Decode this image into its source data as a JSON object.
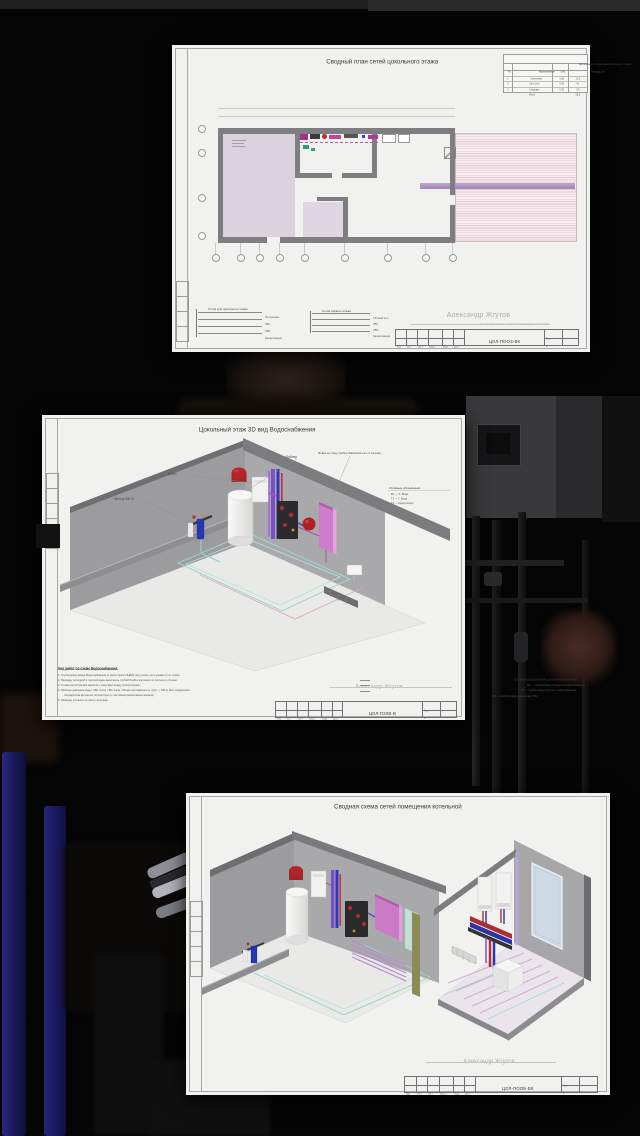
{
  "scene": {
    "colors": {
      "bg": "#050505",
      "paper": "#f1f1ef",
      "accent_red": "#b02424",
      "accent_blue": "#2c34b0",
      "accent_pink": "#ce7cc9",
      "accent_teal": "#9ad6ca"
    }
  },
  "sheet_plan": {
    "title": "Сводный план сетей цокольного этажа",
    "room_table": {
      "title": "Экспликация помещений цокольного этажа",
      "columns": [
        "№",
        "Наименование",
        "Отм.",
        "Площадь, м²"
      ],
      "rows": [
        [
          "1",
          "Котельная",
          "0,00",
          "13,2"
        ],
        [
          "2",
          "Сан. узел",
          "0,00",
          "4,1"
        ],
        [
          "3",
          "Кладовая",
          "0,00",
          "9,6"
        ],
        [
          "",
          "Итого",
          "",
          "26,9"
        ]
      ]
    },
    "legend_groups": [
      {
        "title": "Стояк для цокольного этажа",
        "items": [
          "Отопление",
          "ГВС",
          "ХВС",
          "Канализация"
        ]
      },
      {
        "title": "Стояк первого этажа",
        "items": [
          "Тёплый пол",
          "ГВС",
          "ХВС",
          "Канализация"
        ]
      }
    ],
    "watermark": {
      "name": "Александр Жгутов",
      "sub": "проектирование и монтаж инженерных систем"
    },
    "stamp": {
      "cells": [
        "Изм.",
        "Кол.",
        "Лист",
        "№док.",
        "Подп.",
        "Дата"
      ],
      "code": "ЦОЛ-ПООЗ-ВК",
      "sheet_label": "Лист",
      "sheet_no": "1"
    }
  },
  "sheet_iso": {
    "title": "Цокольный этаж  3D вид Водоснабжения",
    "annotations": {
      "boiler": "Котёл",
      "filter": "Фильтр BB 10",
      "tank": "Бойлер",
      "sink": "Мойка на стену, прибор Waterblock на 1-2 см ниже"
    },
    "legend": {
      "title": "Условные обозначения",
      "items": [
        "В1 — Х. Вода",
        "Т3 — Г. Вода",
        "Т4 — Циркуляция"
      ]
    },
    "notes": {
      "title": "Ход работ по схеме Водоснабжения:",
      "lines": [
        "1. Трубопровод ввода Водоснабжения от магистрали ПНД32 под узлом учёта развести по схеме.",
        "2. Разводку холодной и горячей воды выполнить трубой PexB в изоляции по потолку и стенам.",
        "3. Стояки магистралей закрепить хомутами между коллекторами.",
        "4. Рабочее давление воды: ХВС 3 атм, ГВС 3 атм. Общая протяжённость труб — 180 м. Все соединения",
        "посредством фитингов, коллекторы по чертежам (каталожные номера).",
        "5. Размеры уточнять по месту монтажа."
      ]
    },
    "legend_bottom": {
      "title": "Условные обозначения схем водоснабжения",
      "items": [
        "В1 — трубопровод холодного водоснабжения",
        "Т3 — трубопровод горячего водоснабжения",
        "Т4 — трубопровод циркуляции ГВС"
      ]
    },
    "watermark": {
      "name": "Александр Жгутов"
    },
    "stamp": {
      "cells": [
        "Изм.",
        "Кол.",
        "Лист",
        "№док.",
        "Подп.",
        "Дата"
      ],
      "code": "ЦОЛ-П20В-В",
      "sheet_label": "Лист",
      "sheet_no": "1"
    }
  },
  "sheet_boiler": {
    "title": "Сводная схема сетей помещения котельной",
    "watermark": {
      "name": "Александр Жгутов"
    },
    "stamp": {
      "cells": [
        "Изм.",
        "Кол.",
        "Лист",
        "№док.",
        "Подп.",
        "Дата"
      ],
      "code": "ЦОЛ-ПООБ-ВК",
      "sheet_label": "Лист",
      "sheet_no": "1"
    }
  }
}
